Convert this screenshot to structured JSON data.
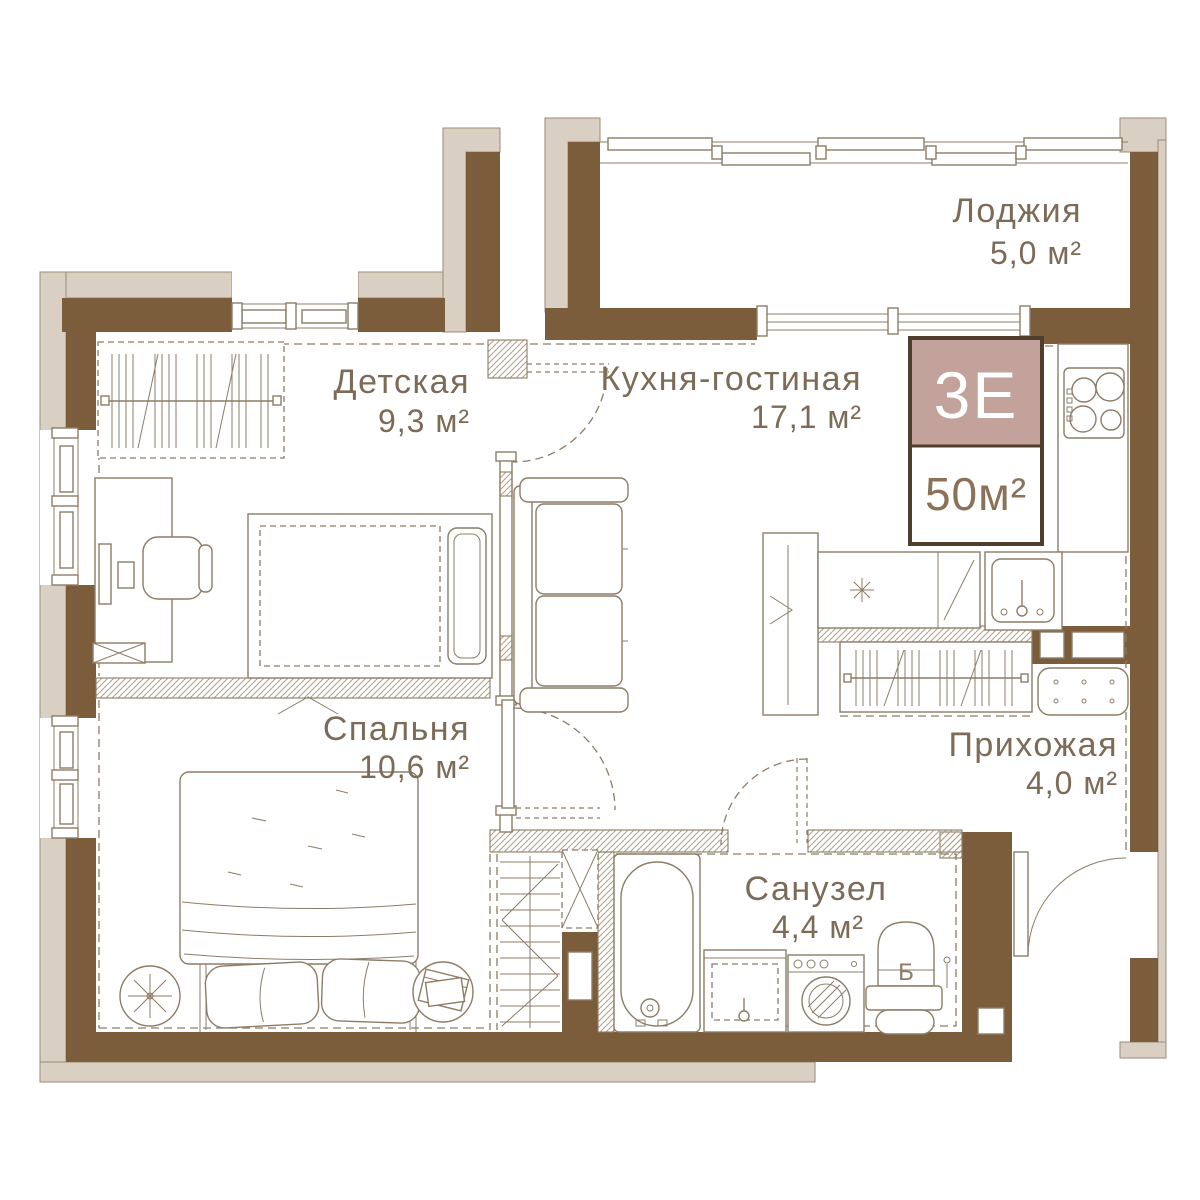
{
  "plan": {
    "badge": {
      "type": "3Е",
      "total_area": "50м²"
    },
    "rooms": {
      "loggia": {
        "name": "Лоджия",
        "area": "5,0 м²"
      },
      "kids": {
        "name": "Детская",
        "area": "9,3 м²"
      },
      "kitchen": {
        "name": "Кухня-гостиная",
        "area": "17,1 м²"
      },
      "bedroom": {
        "name": "Спальня",
        "area": "10,6 м²"
      },
      "hallway": {
        "name": "Прихожая",
        "area": "4,0 м²"
      },
      "bathroom": {
        "name": "Санузел",
        "area": "4,4 м²"
      }
    },
    "boiler_label": "Б",
    "colors": {
      "wall": "#7b5c3b",
      "wall_outer": "#d9d0c3",
      "line": "#8d7c66",
      "text": "#7c6b57",
      "badge_bg": "#c3a29b",
      "badge_border": "#4f3e2b",
      "badge_area_text": "#8a7158"
    }
  }
}
